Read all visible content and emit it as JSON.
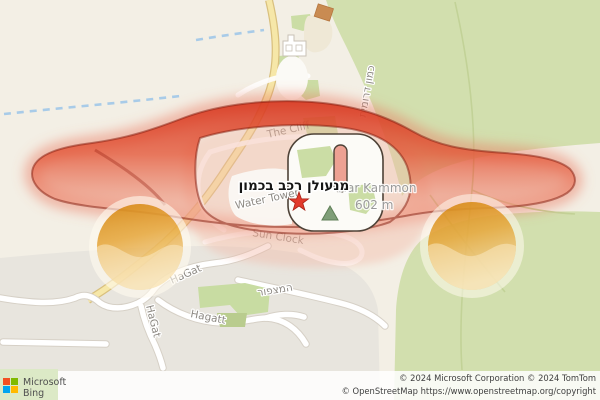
{
  "map": {
    "pushpin": {
      "label": "מנעולן רכב בכמון"
    },
    "peak": {
      "name": "Har Kammon",
      "elevation": "602 m"
    },
    "labels": {
      "the_cliff": "The Cliff",
      "water_tower": "Water Tower",
      "sun_clock": "Sun Clock",
      "hagat": "HaGat",
      "hagatt": "Hagatt",
      "hamitzpor": "המצפור",
      "kamon_road": "כמון דרומית"
    },
    "colors": {
      "overlay_red": "#DF3A22",
      "overlay_pink": "#F3B4A2",
      "wheel_orange": "#E39A33",
      "forest_green": "#D2DFAE",
      "pushpin_red": "#E23A2B",
      "peak_green": "#7F9E78",
      "yellow_road": "#F6E7A8"
    }
  },
  "attribution": {
    "brand_line1": "Microsoft",
    "brand_line2": "Bing",
    "copyright_line1": "© 2024 Microsoft Corporation © 2024 TomTom",
    "copyright_line2": "© OpenStreetMap https://www.openstreetmap.org/copyright"
  }
}
